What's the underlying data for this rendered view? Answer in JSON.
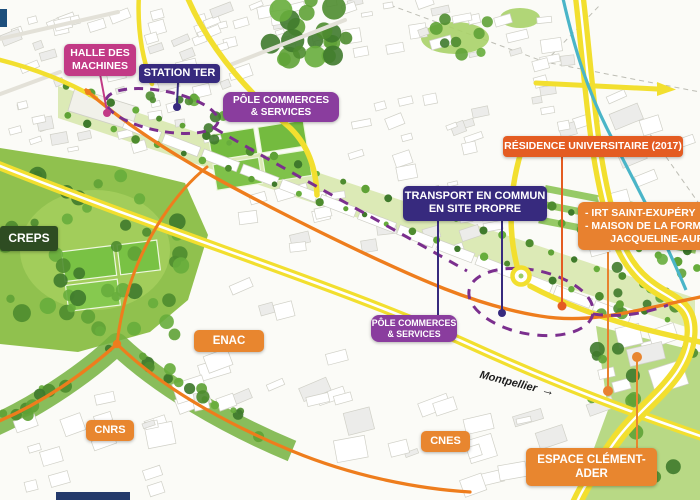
{
  "colors": {
    "road_yellow": "#f2df2f",
    "water_teal": "#4ab5c8",
    "route_orange": "#ee7d1d",
    "tcsp_purple": "#7b2f8e"
  },
  "labels": {
    "halle": {
      "lines": [
        "HALLE DES",
        "MACHINES"
      ],
      "color": "#c23a86"
    },
    "station_ter": {
      "lines": [
        "STATION TER"
      ],
      "color": "#372a7e"
    },
    "pole_commerces_nord": {
      "lines": [
        "PÔLE COMMERCES",
        "& SERVICES"
      ],
      "color": "#8a3d9e"
    },
    "residence_universitaire": {
      "lines": [
        "RÉSIDENCE UNIVERSITAIRE (2017)"
      ],
      "color": "#e45c22"
    },
    "transport_commun": {
      "lines": [
        "TRANSPORT EN COMMUN",
        "EN SITE PROPRE"
      ],
      "color": "#372a7e"
    },
    "irt_maison": {
      "lines": [
        "- IRT SAINT-EXUPÉRY",
        "- MAISON DE LA FORMA",
        "JACQUELINE-AURIOL"
      ],
      "color": "#e8812f"
    },
    "creps": {
      "lines": [
        "CREPS"
      ],
      "color": "#2e4c22"
    },
    "enac": {
      "lines": [
        "ENAC"
      ],
      "color": "#e8862f"
    },
    "pole_commerces_sud": {
      "lines": [
        "PÔLE COMMERCES",
        "& SERVICES"
      ],
      "color": "#8a3d9e"
    },
    "cnrs": {
      "lines": [
        "CNRS"
      ],
      "color": "#e8862f"
    },
    "cnes": {
      "lines": [
        "CNES"
      ],
      "color": "#e8862f"
    },
    "espace_clement_ader": {
      "lines": [
        "ESPACE CLÉMENT-ADER"
      ],
      "color": "#e8862f"
    },
    "montpellier": {
      "text": "Montpellier",
      "arrow": "→"
    }
  }
}
